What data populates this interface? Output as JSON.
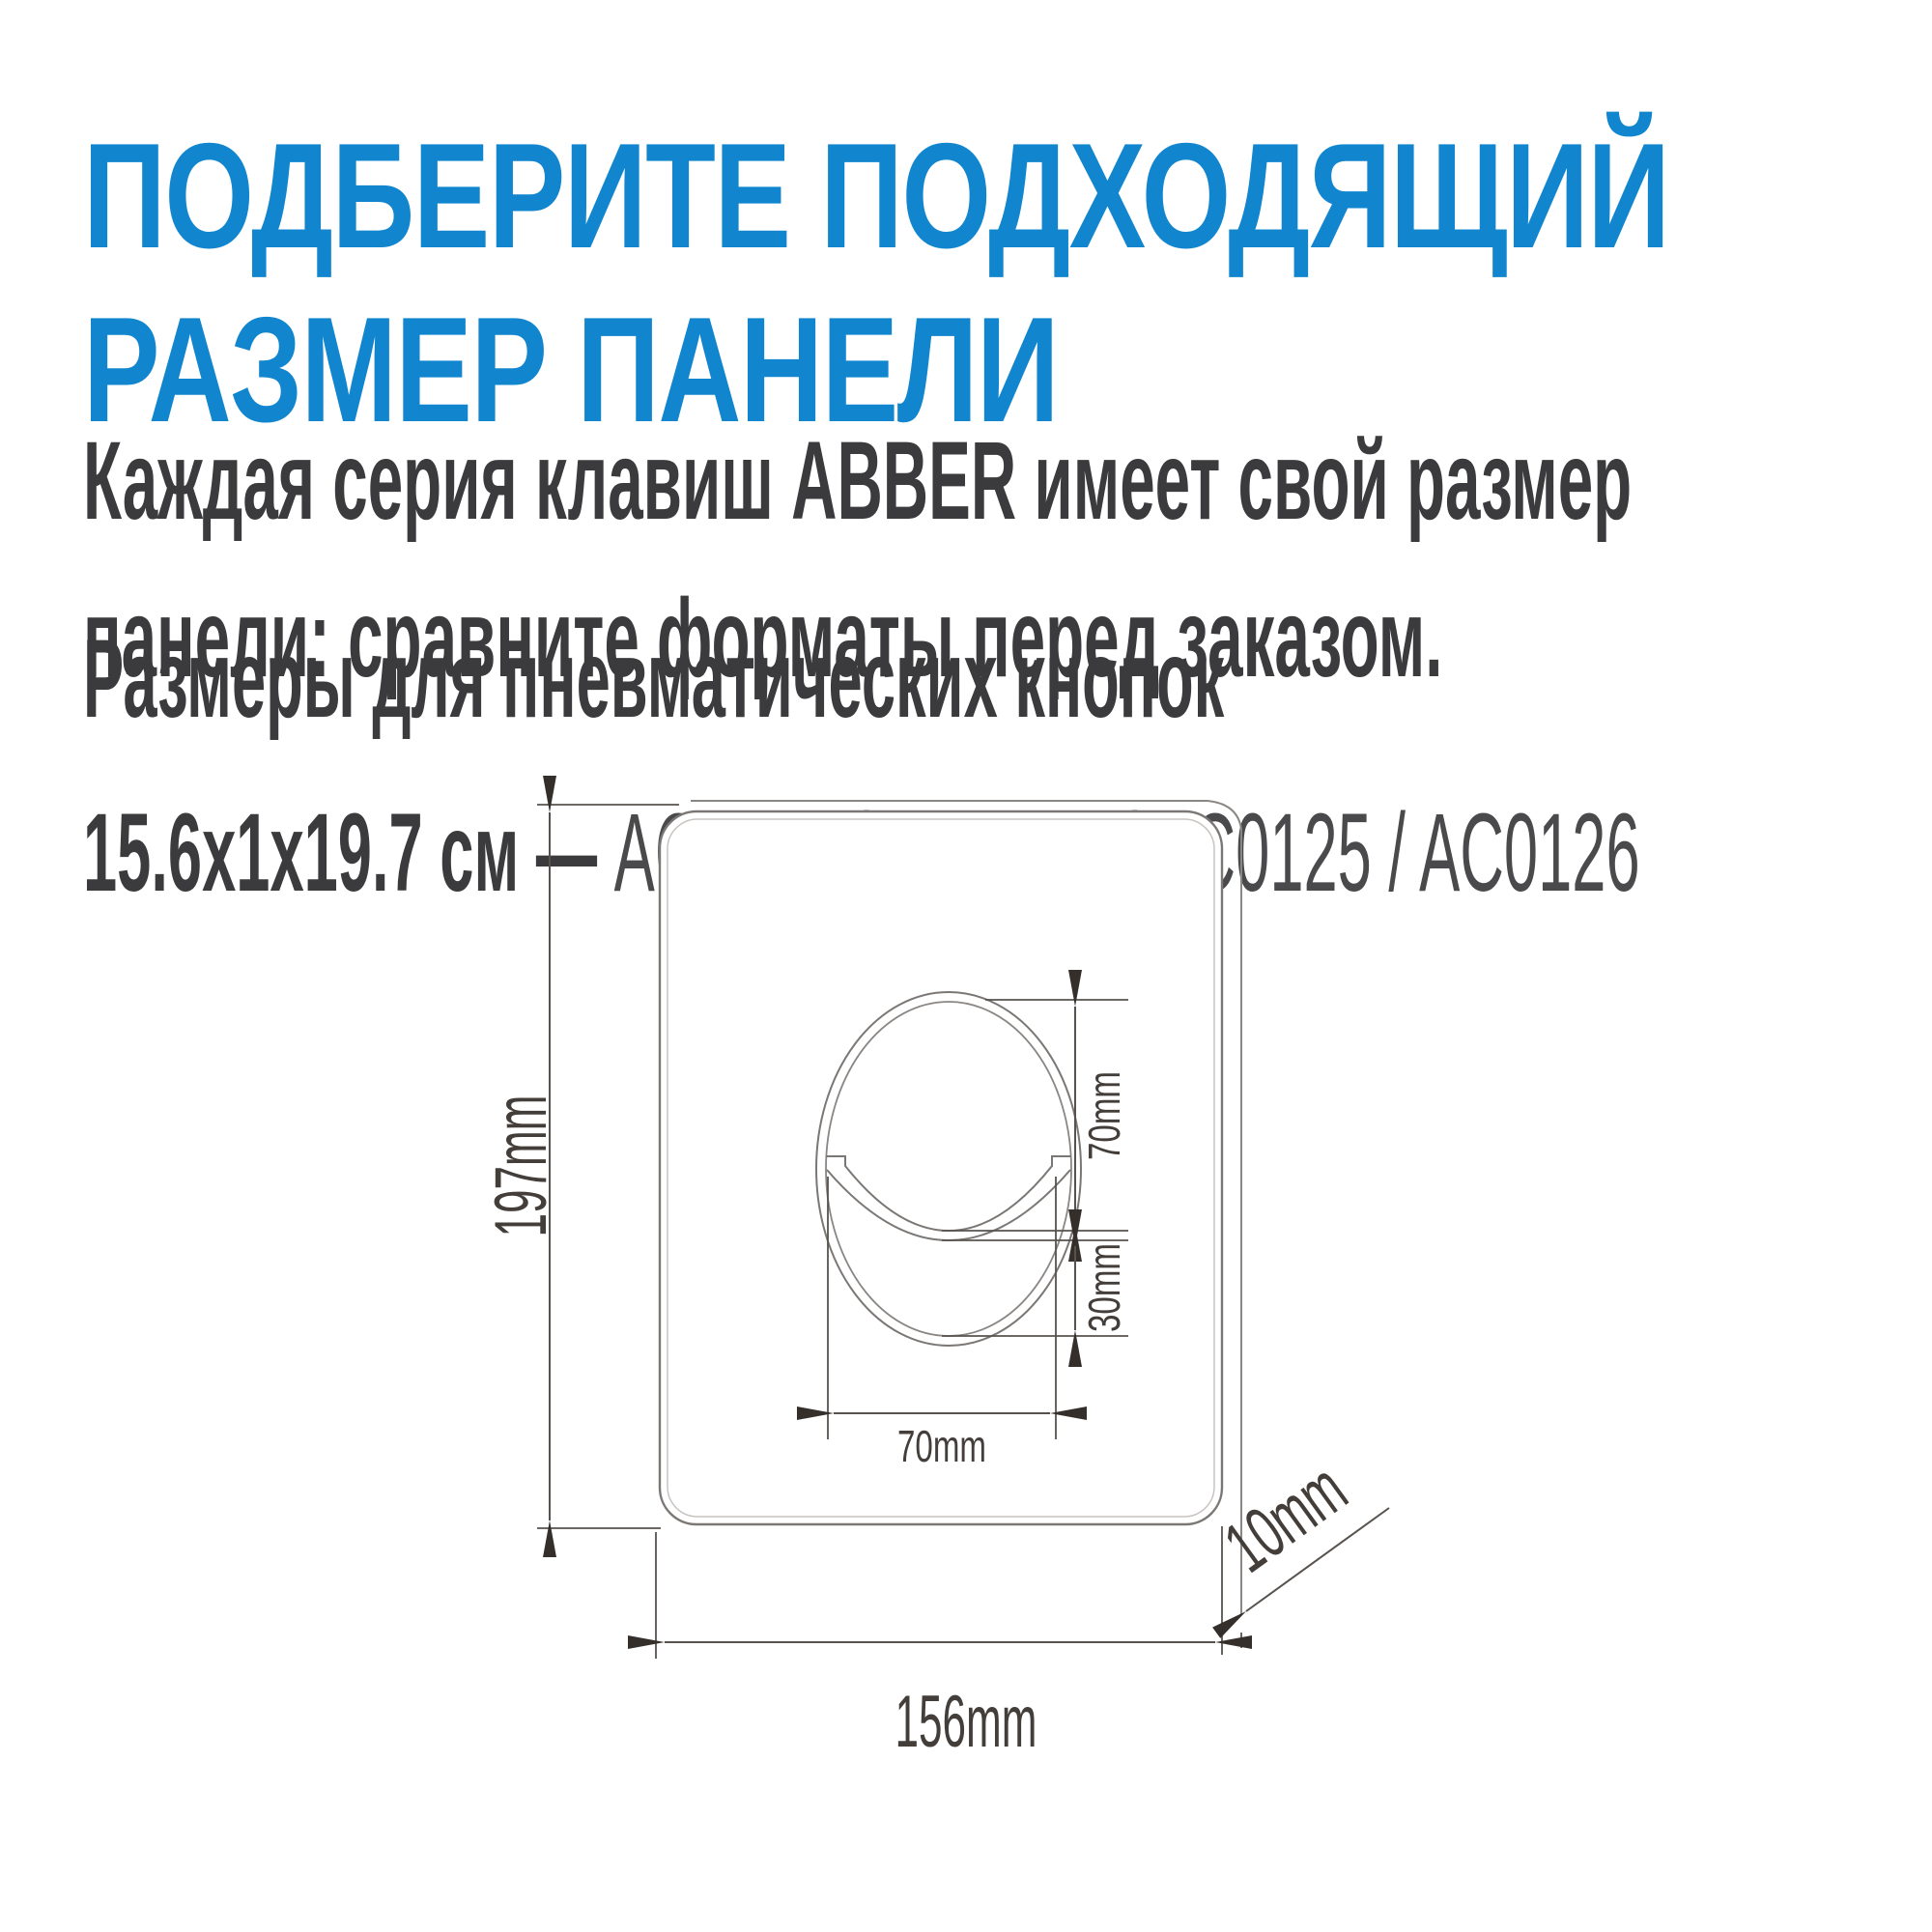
{
  "title": {
    "line1": "ПОДБЕРИТЕ ПОДХОДЯЩИЙ",
    "line2": "РАЗМЕР ПАНЕЛИ",
    "accent_color": "#1186cf"
  },
  "intro": {
    "line1": "Каждая серия клавиш ABBER имеет свой размер",
    "line2": "панели: сравните форматы перед заказом."
  },
  "section": {
    "heading": "Размеры для пневматических кнопок",
    "size_bold": "15.6x1x19.7 см —",
    "models": "AC0123 / AC0124 / AC0125 / AC0126"
  },
  "diagram": {
    "panel_height_label": "197mm",
    "panel_width_label": "156mm",
    "panel_depth_label": "10mm",
    "button_upper_height_label": "70mm",
    "button_lower_height_label": "30mm",
    "button_width_label": "70mm",
    "line_color": "#7b7774",
    "dim_color": "#57524e"
  }
}
